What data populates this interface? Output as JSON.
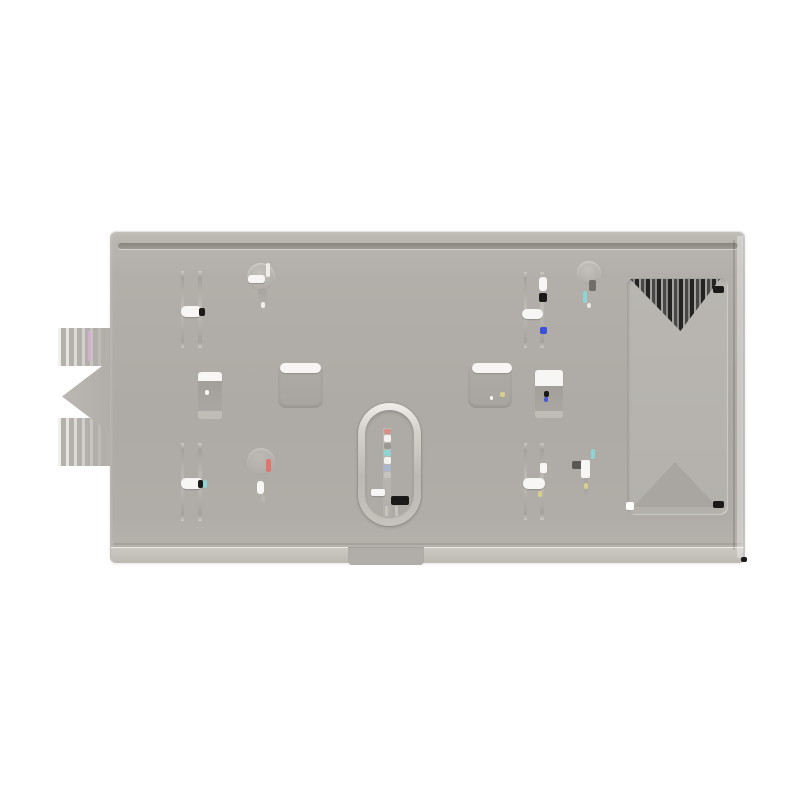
{
  "scene": {
    "subject": "wall-mount bracket plate product photo",
    "background_color": "#ffffff"
  },
  "colors": {
    "bg": "#ffffff",
    "face": "#b0aca7",
    "face-light": "#bcb8b2",
    "lip": "#cac6c0",
    "groove": "#8d8a83",
    "slot-white": "#f7f6f4",
    "recess": "#a6a29d",
    "ring-light": "#efedea",
    "cutout": "#b7b4af",
    "dark": "#403e3c",
    "black": "#1b1a19",
    "red": "#e0756d",
    "cyan": "#8fd4d4",
    "blue": "#3a50d9",
    "yellow": "#d6cf8e",
    "magenta": "#d9aed9"
  },
  "parts": [
    "mounting-plate",
    "top-edge-groove",
    "bottom-lip",
    "bottom-center-tab",
    "left-toothed-wing",
    "wing-arrow-tab",
    "slot-pair-top-left",
    "slot-pair-bottom-left",
    "slot-pair-top-right",
    "slot-pair-bottom-right",
    "keyhole-top-left",
    "keyhole-bottom-left",
    "keyhole-top-right",
    "keyhole-bottom-right",
    "square-hole-left",
    "square-hole-right",
    "recess-rect-left",
    "recess-rect-right",
    "stadium-boss-center",
    "stadium-slot",
    "large-right-cutout",
    "cutout-dark-triangle",
    "cutout-gray-triangle"
  ]
}
